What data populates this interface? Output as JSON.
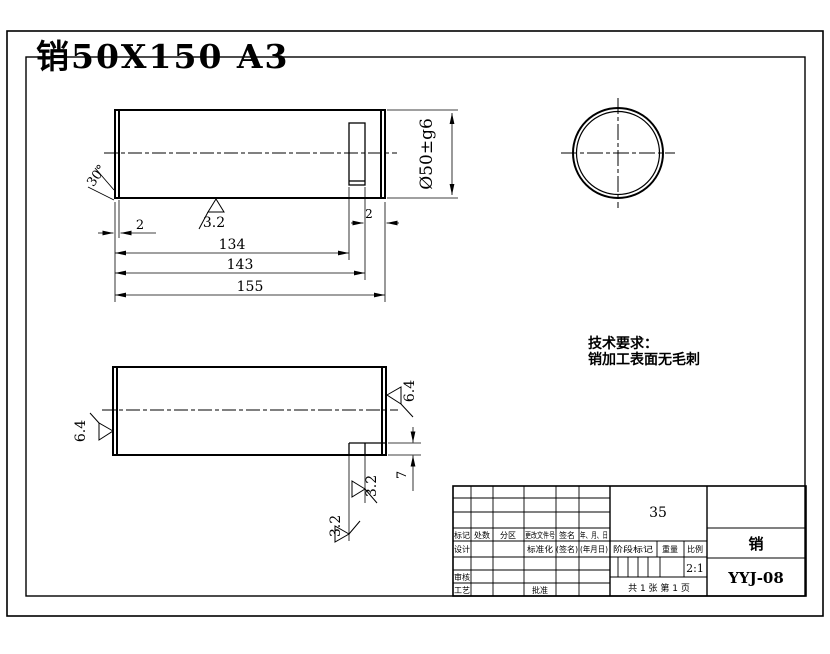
{
  "title": "销50X150 A3",
  "colors": {
    "title_red": "#ee1100",
    "line": "#000000",
    "background": "#ffffff"
  },
  "top_view": {
    "chamfer_angle": "30°",
    "chamfer_width": "2",
    "groove_width": "2",
    "len_to_groove": "134",
    "len_to_groove_end": "143",
    "len_total": "155",
    "diameter": "Ø50±g6",
    "roughness": "3.2"
  },
  "end_view": {},
  "bottom_view": {
    "roughness_left": "6.4",
    "roughness_right": "6.4",
    "roughness_groove_a": "3.2",
    "roughness_groove_b": "3.2",
    "groove_depth": "7"
  },
  "tech_req": {
    "line1": "技术要求：",
    "line2": "销加工表面无毛刺"
  },
  "title_block": {
    "material": "35",
    "part_name": "销",
    "drawing_no": "YYJ-08",
    "scale_value": "2:1",
    "sheet_info": "共 1 张  第 1 页",
    "headers": {
      "mark": "标记",
      "count": "处数",
      "zone": "分区",
      "change_doc": "更改文件号",
      "signature": "签名",
      "date": "年、月、日"
    },
    "rows": {
      "design": "设计",
      "standardization": "标准化",
      "sig_paren": "(签名)",
      "date_paren": "(年月日)",
      "check": "审核",
      "process": "工艺",
      "approve": "批准"
    },
    "stage": {
      "stage_mark": "阶段标记",
      "weight": "重量",
      "scale_label": "比例"
    }
  }
}
